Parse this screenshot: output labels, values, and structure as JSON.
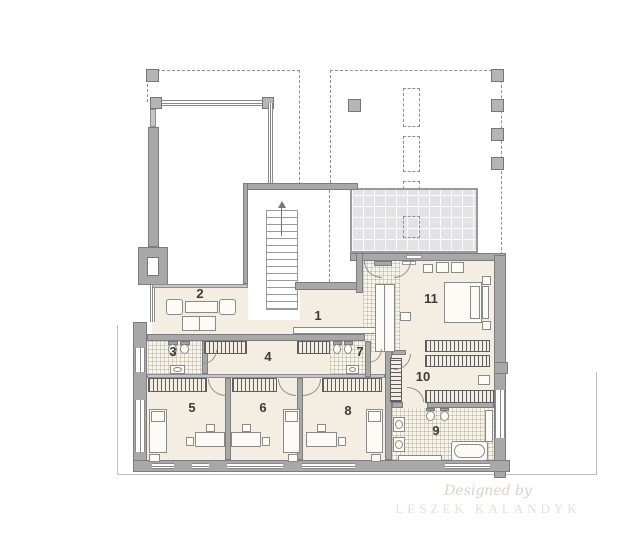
{
  "rooms": [
    {
      "number": "1"
    },
    {
      "number": "2"
    },
    {
      "number": "3"
    },
    {
      "number": "4"
    },
    {
      "number": "5"
    },
    {
      "number": "6"
    },
    {
      "number": "7"
    },
    {
      "number": "8"
    },
    {
      "number": "9"
    },
    {
      "number": "10"
    },
    {
      "number": "11"
    }
  ],
  "watermark": {
    "script_line": "Designed by",
    "name_line": "LESZEK KALANDYK"
  },
  "colors": {
    "wall": "#a8a8a8",
    "floor": "#f3eee1",
    "tilebg": "#f7f4ea",
    "skylight": "#e3e3e5"
  }
}
